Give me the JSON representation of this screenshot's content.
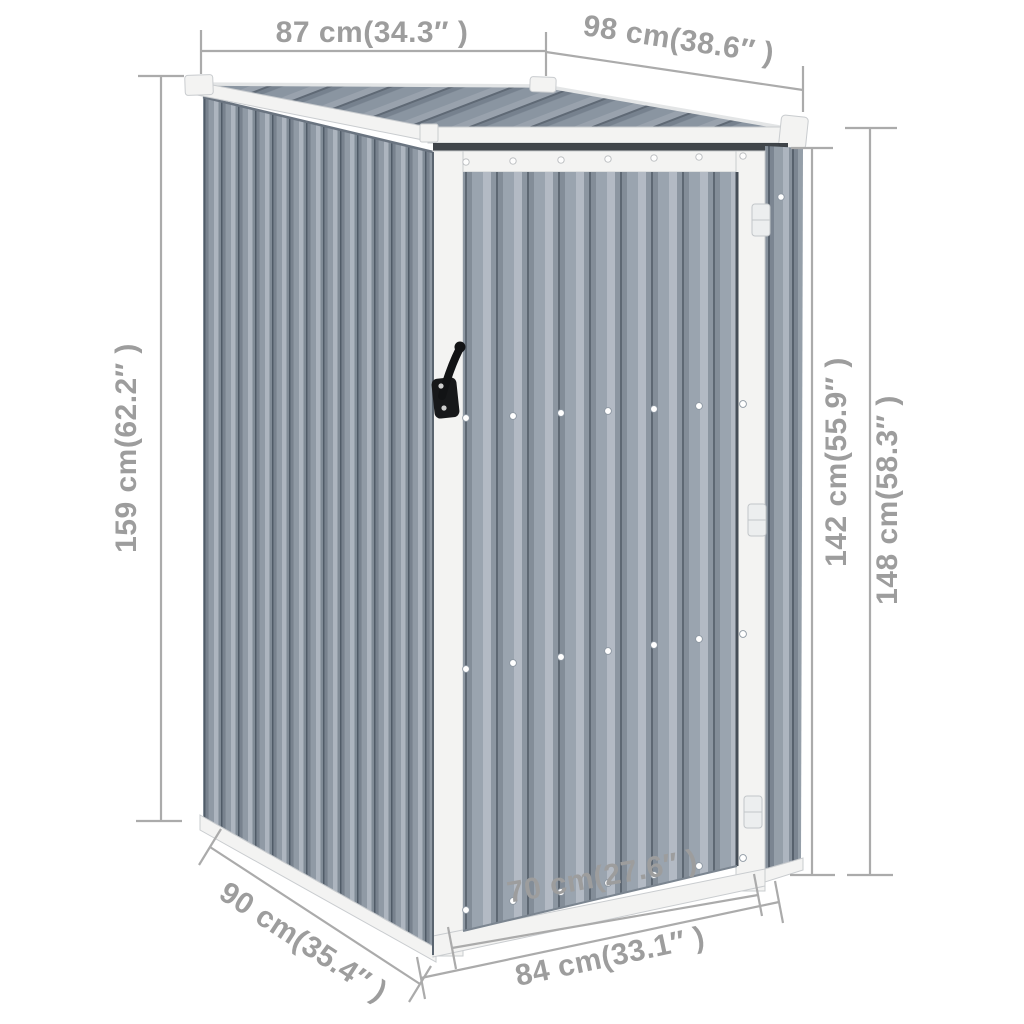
{
  "figure": {
    "alt": "Gray corrugated metal garden shed with slanted pent roof, front door with black latch handle, annotated with dimension lines"
  },
  "dimensions": {
    "roof_width": {
      "label": "87 cm(34.3″ )"
    },
    "roof_depth": {
      "label": "98 cm(38.6″ )"
    },
    "height_left": {
      "label": "159 cm(62.2″ )"
    },
    "height_door": {
      "label": "142 cm(55.9″ )"
    },
    "height_right": {
      "label": "148 cm(58.3″ )"
    },
    "base_depth": {
      "label": "90 cm(35.4″ )"
    },
    "door_width": {
      "label": "70 cm(27.6″ )"
    },
    "base_width": {
      "label": "84 cm(33.1″ )"
    }
  },
  "colors": {
    "background": "#ffffff",
    "dimension_line": "#ababab",
    "dimension_text": "#9d9d9d",
    "trim_white": "#f3f3f2",
    "trim_edge": "#c9cccf",
    "wall_face": "#909aa5",
    "wall_highlight": "#adb5bf",
    "wall_shadow": "#505b67",
    "door_face": "#9aa4af",
    "door_highlight": "#b3bac4",
    "door_shadow": "#5e6873",
    "roof_face": "#8a95a1",
    "roof_shadow": "#5f6975",
    "gap_dark": "#262b31",
    "handle_black": "#17181a"
  }
}
